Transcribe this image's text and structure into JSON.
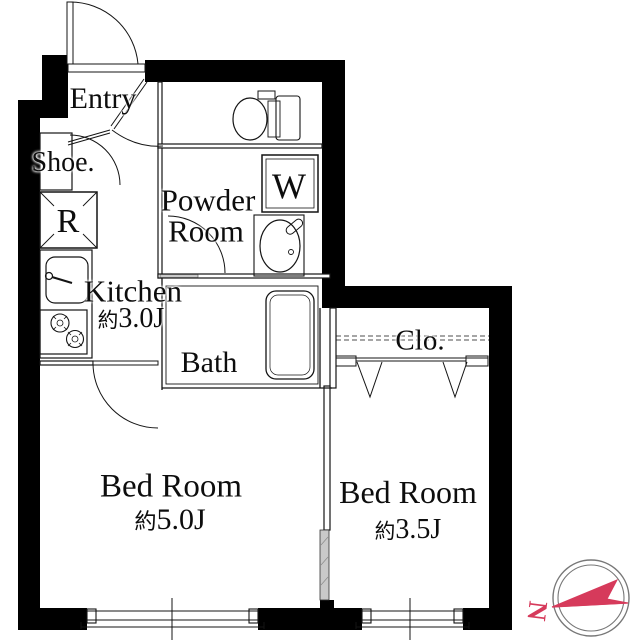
{
  "plan_type": "apartment-floor-plan",
  "rooms": {
    "entry": {
      "label": "Entry"
    },
    "shoe": {
      "label": "Shoe."
    },
    "fridge": {
      "label": "R"
    },
    "powder": {
      "label_line1": "Powder",
      "label_line2": "Room"
    },
    "washer": {
      "label": "W"
    },
    "kitchen": {
      "label": "Kitchen",
      "size_prefix": "約",
      "size_value": "3.0J"
    },
    "bath": {
      "label": "Bath"
    },
    "closet": {
      "label": "Clo."
    },
    "bedroom_main": {
      "label": "Bed Room",
      "size_prefix": "約",
      "size_value": "5.0J"
    },
    "bedroom_second": {
      "label": "Bed Room",
      "size_prefix": "約",
      "size_value": "3.5J"
    }
  },
  "compass": {
    "north_label": "N",
    "needle_color": "#d63a5b",
    "ring_color": "#777777"
  },
  "colors": {
    "wall": "#000000",
    "line": "#141414",
    "background": "#ffffff",
    "slide_door_fill": "#c9c9c9"
  }
}
